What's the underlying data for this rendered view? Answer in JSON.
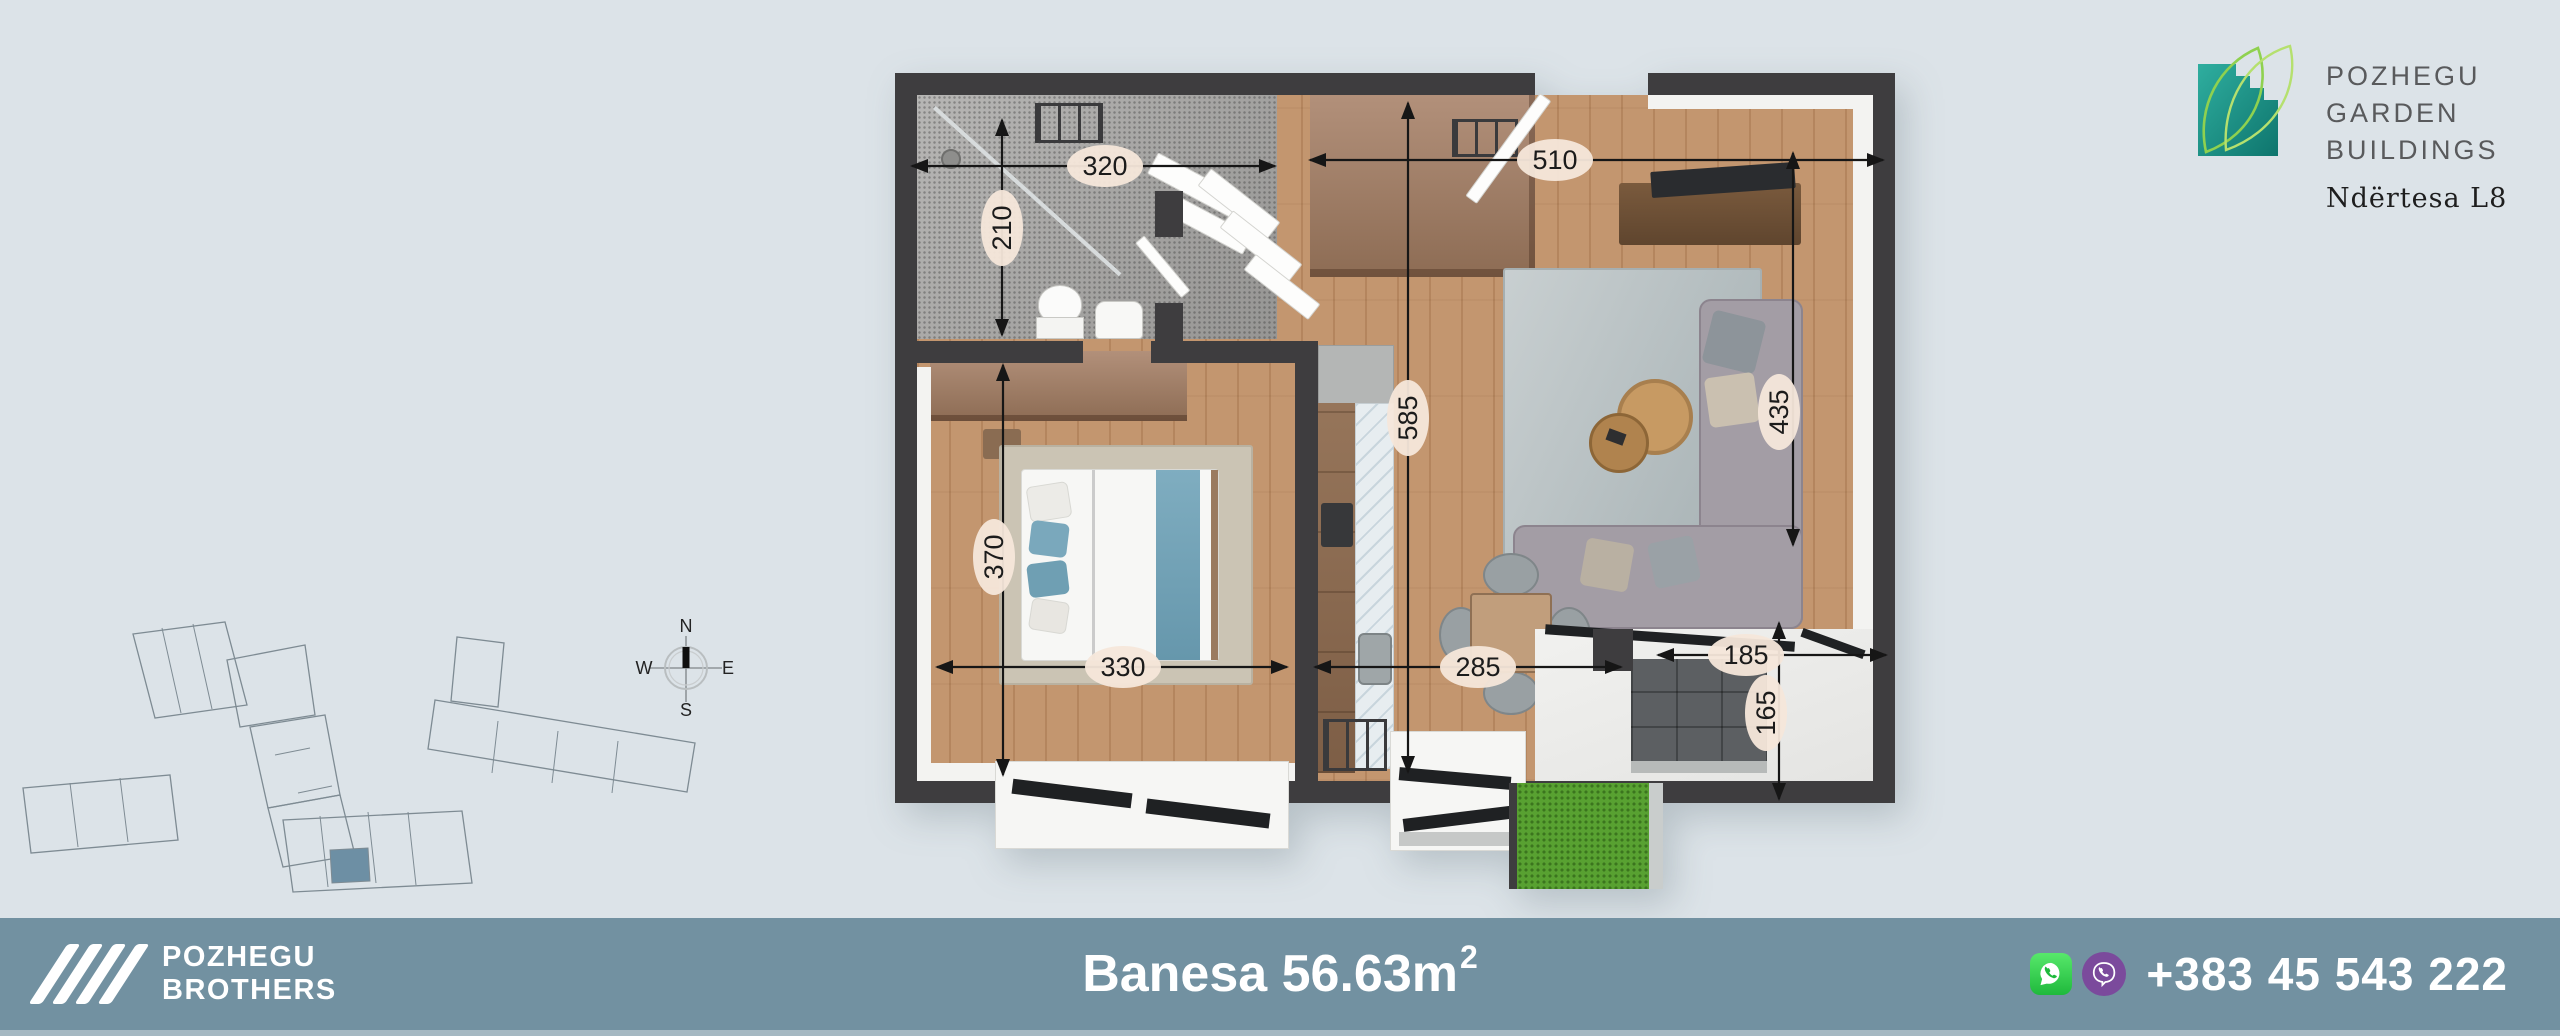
{
  "page": {
    "width": 2560,
    "height": 1036,
    "background": "#dce3e8"
  },
  "logo": {
    "line1": "POZHEGU",
    "line2": "GARDEN",
    "line3": "BUILDINGS",
    "building": "Ndërtesa L8"
  },
  "compass": {
    "north": "N",
    "east": "E",
    "south": "S",
    "west": "W"
  },
  "floor_plan": {
    "dimensions": [
      {
        "value": "320",
        "orient": "h",
        "x1": 17,
        "x2": 380,
        "y": 93,
        "lx": 210,
        "ly": 93
      },
      {
        "value": "210",
        "orient": "v",
        "x": 107,
        "y1": 47,
        "y2": 262,
        "lx": 107,
        "ly": 155
      },
      {
        "value": "510",
        "orient": "h",
        "x1": 415,
        "x2": 988,
        "y": 87,
        "lx": 660,
        "ly": 87
      },
      {
        "value": "585",
        "orient": "v",
        "x": 513,
        "y1": 30,
        "y2": 699,
        "lx": 513,
        "ly": 345
      },
      {
        "value": "435",
        "orient": "v",
        "x": 898,
        "y1": 80,
        "y2": 472,
        "lx": 884,
        "ly": 339
      },
      {
        "value": "370",
        "orient": "v",
        "x": 108,
        "y1": 292,
        "y2": 702,
        "lx": 99,
        "ly": 484
      },
      {
        "value": "330",
        "orient": "h",
        "x1": 42,
        "x2": 392,
        "y": 594,
        "lx": 228,
        "ly": 594
      },
      {
        "value": "285",
        "orient": "h",
        "x1": 420,
        "x2": 726,
        "y": 594,
        "lx": 583,
        "ly": 594
      },
      {
        "value": "185",
        "orient": "h",
        "x1": 763,
        "x2": 991,
        "y": 582,
        "lx": 851,
        "ly": 582
      },
      {
        "value": "165",
        "orient": "v",
        "x": 884,
        "y1": 550,
        "y2": 726,
        "lx": 871,
        "ly": 640
      }
    ]
  },
  "site_plan": {
    "outline_color": "#7e8b93",
    "highlight_color": "#6d8fa4",
    "buildings": [
      "123,19 215,7 237,90 145,103",
      "217,45 295,30 305,100 230,112",
      "240,112 315,100 330,180 258,193",
      "258,193 330,180 345,240 273,252",
      "273,205 452,196 462,268 283,277",
      "425,85 685,128 677,177 418,134",
      "13,173 160,160 168,225 21,238",
      "447,22 494,28 488,92 441,86"
    ],
    "dividers": [
      [
        152,
        13,
        171,
        98
      ],
      [
        183,
        9,
        202,
        94
      ],
      [
        310,
        201,
        318,
        272
      ],
      [
        358,
        197,
        366,
        268
      ],
      [
        398,
        197,
        406,
        270
      ],
      [
        488,
        106,
        482,
        158
      ],
      [
        548,
        116,
        542,
        168
      ],
      [
        608,
        126,
        602,
        178
      ],
      [
        60,
        168,
        68,
        232
      ],
      [
        110,
        163,
        118,
        227
      ],
      [
        265,
        140,
        300,
        133
      ],
      [
        288,
        178,
        322,
        171
      ]
    ],
    "highlight": "320,235 358,233 360,266 322,268"
  },
  "footer": {
    "brand_line1": "POZHEGU",
    "brand_line2": "BROTHERS",
    "area_label": "Banesa 56.63m",
    "area_sup": "2",
    "phone": "+383 45 543 222"
  },
  "icons": {
    "leaf": "garden-leaf-logo-icon",
    "compass": "compass-rose-icon",
    "slashes": "brand-slashes-icon",
    "whatsapp": "whatsapp-icon",
    "viber": "viber-icon"
  },
  "colors": {
    "background": "#dce3e8",
    "footer_bar": "#7291a1",
    "footer_strip": "#a5b8c2",
    "wall": "#3e3d3f",
    "wood_floor": "#c09067",
    "bathroom_tile": "#a7a6a4",
    "rug": "#b6bfc1",
    "sofa": "#a39da5",
    "bed_accent": "#6f9fb3",
    "grass": "#58a131",
    "logo_teal": "#18877e",
    "logo_leaf_green": "#8fd14f",
    "whatsapp_green": "#1fb93c",
    "viber_purple": "#7b4a9c",
    "dimension_chip": "#f5e7da"
  }
}
